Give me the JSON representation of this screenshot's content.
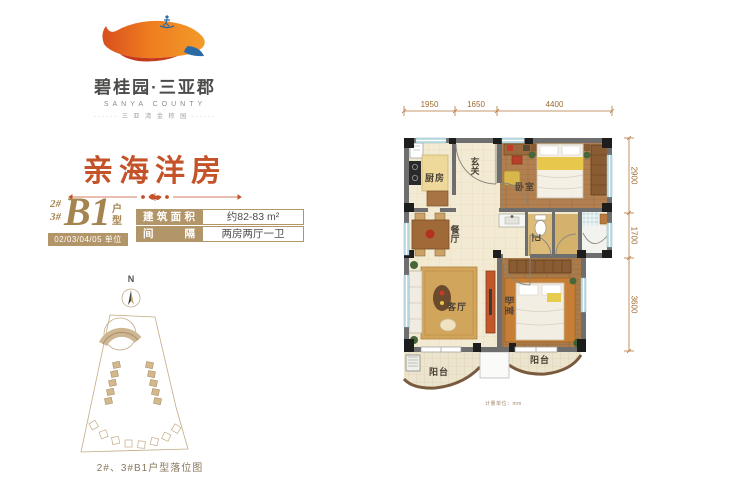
{
  "brand": {
    "name": "碧桂园·三亚郡",
    "subtitle": "SANYA COUNTY",
    "tagline": "······ 三 亚 湾 金 棕 园 ······"
  },
  "headline": {
    "title": "亲海洋房"
  },
  "unit": {
    "block_line1": "2#",
    "block_line2": "3#",
    "type_code": "B1",
    "type_label": "户型",
    "units_bar": "02/03/04/05 单位"
  },
  "spec_table": {
    "rows": [
      {
        "label": "建筑面积",
        "value": "约82-83 m²"
      },
      {
        "label": "间隔",
        "value": "两房两厅一卫"
      }
    ]
  },
  "site_plan": {
    "compass": "N",
    "caption": "2#、3#B1户型落位图"
  },
  "floor_plan": {
    "dims_top": [
      "1950",
      "1650",
      "4400"
    ],
    "dims_right": [
      "2900",
      "1700",
      "3600"
    ],
    "rooms": {
      "kitchen": "厨房",
      "foyer": "玄关",
      "bedroom1": "卧室",
      "dining": "餐厅",
      "bath": "卫",
      "living": "客厅",
      "bedroom2": "卧室",
      "balcony_left": "阳台",
      "balcony_right": "阳台"
    },
    "note": "计量单位：mm"
  },
  "colors": {
    "accent_orange": "#c4532a",
    "gold": "#b3956a",
    "dim_line": "#b5773a",
    "wall_gray": "#6e6e6e",
    "window_blue": "#c2dde4"
  }
}
